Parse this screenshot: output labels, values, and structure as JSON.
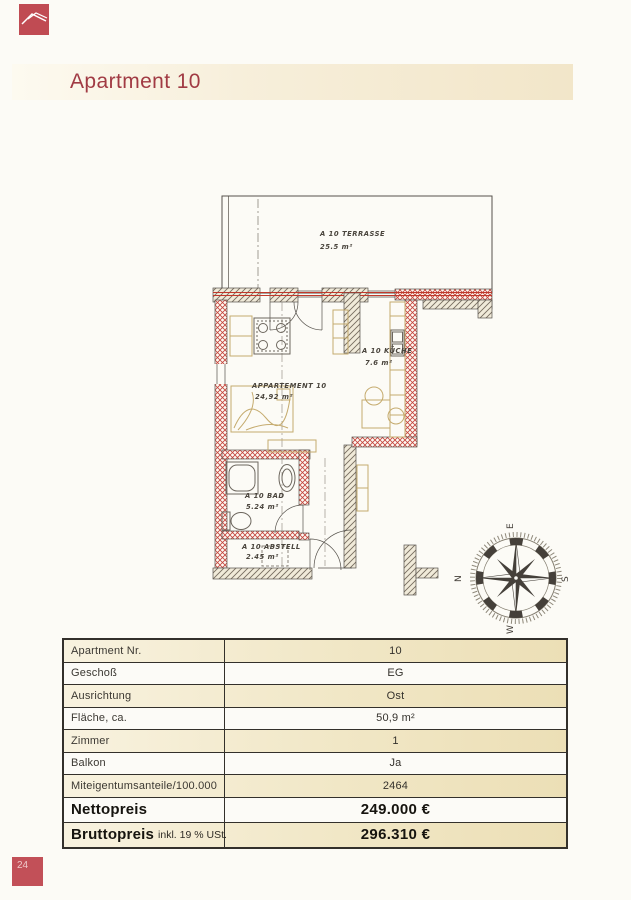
{
  "header": {
    "title": "Apartment 10"
  },
  "floor_plan": {
    "terrace": {
      "name": "A 10 TERRASSE",
      "area": "25.5 m²"
    },
    "living": {
      "name": "APPARTEMENT 10",
      "area": "24,92 m²"
    },
    "kitchen": {
      "name": "A 10 KÜCHE",
      "area": "7.6 m²"
    },
    "bath": {
      "name": "A 10 BAD",
      "area": "5.24 m²"
    },
    "storage": {
      "name": "A 10 ABSTELL",
      "area": "2.45 m²"
    },
    "compass": {
      "top": "E",
      "right": "S",
      "bottom": "W",
      "left": "N"
    }
  },
  "table": {
    "rows": [
      {
        "label": "Apartment Nr.",
        "value": "10"
      },
      {
        "label": "Geschoß",
        "value": "EG"
      },
      {
        "label": "Ausrichtung",
        "value": "Ost"
      },
      {
        "label": "Fläche, ca.",
        "value": "50,9 m²"
      },
      {
        "label": "Zimmer",
        "value": "1"
      },
      {
        "label": "Balkon",
        "value": "Ja"
      },
      {
        "label": "Miteigentumsanteile/100.000",
        "value": "2464"
      },
      {
        "label": "Nettopreis",
        "value": "249.000 €",
        "emphasis": true
      },
      {
        "label": "Bruttopreis",
        "label_suffix": "inkl. 19 % USt.",
        "value": "296.310 €",
        "emphasis": true
      }
    ]
  },
  "footer": {
    "page_number": "24"
  },
  "colors": {
    "accent_red": "#c04b53",
    "title_red": "#a13b44",
    "wall_red": "#c4443c",
    "beige_row": "#f1e7c6"
  }
}
